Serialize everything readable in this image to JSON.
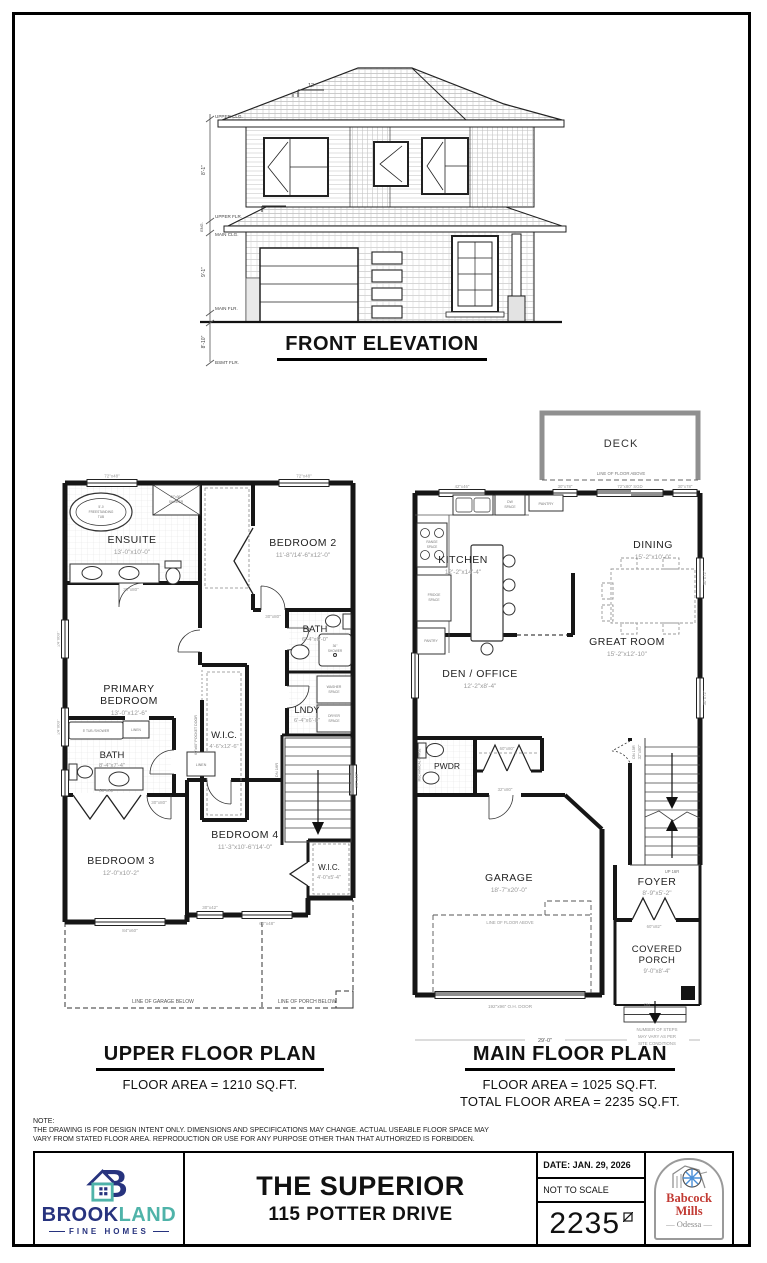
{
  "elevation": {
    "title": "FRONT ELEVATION",
    "levels": {
      "upper_clg": "UPPER CLG.",
      "upper_flr": "UPPER FLR.",
      "main_clg": "MAIN CLG.",
      "main_flr": "MAIN FLR.",
      "bsmt_flr": "BSMT FLR."
    },
    "heights": {
      "upper": "8'-1\"",
      "main": "9'-1\"",
      "bsmt": "8'-10\"",
      "eng": "ENG."
    },
    "pitch": {
      "run": "12",
      "rise": "8"
    }
  },
  "upper_plan": {
    "title": "UPPER FLOOR PLAN",
    "area": "FLOOR AREA = 1210 SQ.FT.",
    "rooms": {
      "ensuite": {
        "name": "ENSUITE",
        "dims": "13'-0\"x10'-0\""
      },
      "bedroom2": {
        "name": "BEDROOM 2",
        "dims": "11'-8\"/14'-6\"x12'-0\""
      },
      "primary": {
        "name": [
          "PRIMARY",
          "BEDROOM"
        ],
        "dims": "13'-0\"x12'-6\""
      },
      "wic": {
        "name": "W.I.C.",
        "dims": "4'-6\"x12'-6\""
      },
      "bath": {
        "name": "BATH",
        "dims": "6'-4\"x6'-0\""
      },
      "lndy": {
        "name": "LNDY",
        "dims": "6'-4\"x6'-0\""
      },
      "bath2": {
        "name": "BATH",
        "dims": "8'-4\"x7'-4\""
      },
      "bedroom3": {
        "name": "BEDROOM 3",
        "dims": "12'-0\"x10'-2\""
      },
      "bedroom4": {
        "name": "BEDROOM 4",
        "dims": "11'-3\"x10'-6\"/14'-0\""
      },
      "wic2": {
        "name": "W.I.C.",
        "dims": "4'-0\"x5'-4\""
      }
    },
    "fixtures": {
      "tub": [
        "5'-0",
        "FREESTANDING",
        "TUB"
      ],
      "shower": [
        "60\"x36\"",
        "SHOWER"
      ],
      "shower36": [
        "36\"",
        "SHOWER"
      ],
      "washer": [
        "WASHER",
        "SPACE"
      ],
      "dryer": [
        "DRYER",
        "SPACE"
      ],
      "tub5": "5' TUB /SHOWER",
      "linen": "LINEN",
      "linen2": "LINEN",
      "pocket_door": "60\"x60\" POCKET DOOR",
      "stairs_dn": "DN 16R"
    },
    "labels": {
      "garage_below": "LINE OF GARAGE BELOW",
      "porch_below": "LINE OF PORCH BELOW",
      "win_top_l": "72\"x48\"",
      "win_top_r": "72\"x48\"",
      "win_left1": "24\"x60\"",
      "win_left2": "24\"x60\"",
      "win_stairs": "30\"x48\"",
      "win_bed3": "84\"x60\"",
      "win_bed4": "60\"x48\"",
      "win_bed4b": "30\"x42\"",
      "door1": "30\"x80\"",
      "door2": "30\"x80\"",
      "door3": "30\"x80\"",
      "closet_doors": "60\"x80\""
    }
  },
  "main_plan": {
    "title": "MAIN FLOOR PLAN",
    "area": "FLOOR AREA = 1025 SQ.FT.",
    "total": "TOTAL FLOOR AREA = 2235 SQ.FT.",
    "rooms": {
      "deck": {
        "name": "DECK"
      },
      "kitchen": {
        "name": "KITCHEN",
        "dims": "12'-2\"x14'-4\""
      },
      "dining": {
        "name": "DINING",
        "dims": "15'-2\"x10'-0\""
      },
      "great": {
        "name": "GREAT ROOM",
        "dims": "15'-2\"x12'-10\""
      },
      "den": {
        "name": "DEN / OFFICE",
        "dims": "12'-2\"x8'-4\""
      },
      "pwdr": {
        "name": "PWDR"
      },
      "garage": {
        "name": "GARAGE",
        "dims": "18'-7\"x20'-0\""
      },
      "foyer": {
        "name": "FOYER",
        "dims": "8'-9\"x5'-2\""
      },
      "porch": {
        "name": [
          "COVERED",
          "PORCH"
        ],
        "dims": "9'-0\"x8'-4\""
      }
    },
    "fixtures": {
      "dw": [
        "DW",
        "SPACE"
      ],
      "pantry": "PANTRY",
      "pantry2": "PANTRY",
      "range": [
        "RANGE",
        "SPACE"
      ],
      "fridge": [
        "FRIDGE",
        "SPACE"
      ],
      "mech": "MECHANICAL CHASE",
      "up": "UP 16R",
      "dn_bsmt": "DN 15R",
      "dn_porch": "DN"
    },
    "labels": {
      "floor_above1": "LINE OF FLOOR ABOVE",
      "floor_above2": "LINE OF FLOOR ABOVE",
      "oh_door": "192\"x96\" O.H. DOOR",
      "dim_width": "29'-0\"",
      "steps": [
        "NUMBER OF STEPS",
        "MAY VARY AS PER",
        "SITE CONDITIONS"
      ],
      "win_kitchen": "42\"x46\"",
      "win_dine1": "30\"x78\"",
      "sgd": "72\"x80\" SGD",
      "win_dine2": "30\"x78\"",
      "win_right1": "30\"x72\"",
      "win_right2": "30\"x72\"",
      "closet": "60\"x80\"",
      "door_garage": "32\"x80\"",
      "door_bsmt": "32\"x80\"",
      "front_door": "60\"x82\""
    }
  },
  "note": {
    "label": "NOTE:",
    "line1": "THE DRAWING IS FOR DESIGN INTENT ONLY.  DIMENSIONS AND SPECIFICATIONS MAY CHANGE. ACTUAL USEABLE FLOOR SPACE MAY",
    "line2": "VARY FROM STATED FLOOR AREA. REPRODUCTION OR USE FOR ANY PURPOSE OTHER THAN THAT AUTHORIZED IS FORBIDDEN."
  },
  "title_block": {
    "model": "THE SUPERIOR",
    "address": "115 POTTER DRIVE",
    "date": "DATE: JAN. 29, 2026",
    "scale": "NOT TO SCALE",
    "sqft": "2235",
    "brookland": {
      "monogram": "B",
      "brook": "BROOK",
      "land": "LAND",
      "tagline": "FINE HOMES"
    },
    "babcock": {
      "line1": "Babcock",
      "line2": "Mills",
      "city": "— Odessa —"
    }
  },
  "colors": {
    "brookland_blue": "#27337e",
    "brookland_teal": "#4fb3a9",
    "babcock_red": "#c23b34",
    "wall": "#161616",
    "dim_gray": "#8a8a8a"
  }
}
